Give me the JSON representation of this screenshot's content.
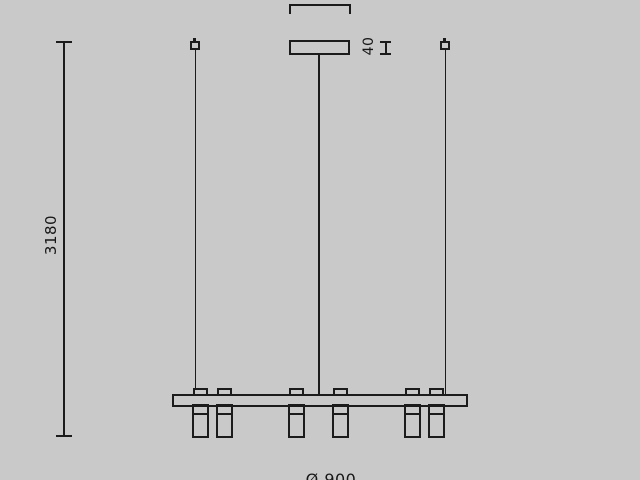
{
  "title": "Pendant lamp technical dimension drawing (side view)",
  "colors": {
    "background": "#c9c9c9",
    "line": "#1b1b1b"
  },
  "labels": {
    "overall_height": "3180",
    "canopy_height": "40",
    "canopy_width": "Ø 180",
    "fixture_diameter": "Ø 900"
  }
}
